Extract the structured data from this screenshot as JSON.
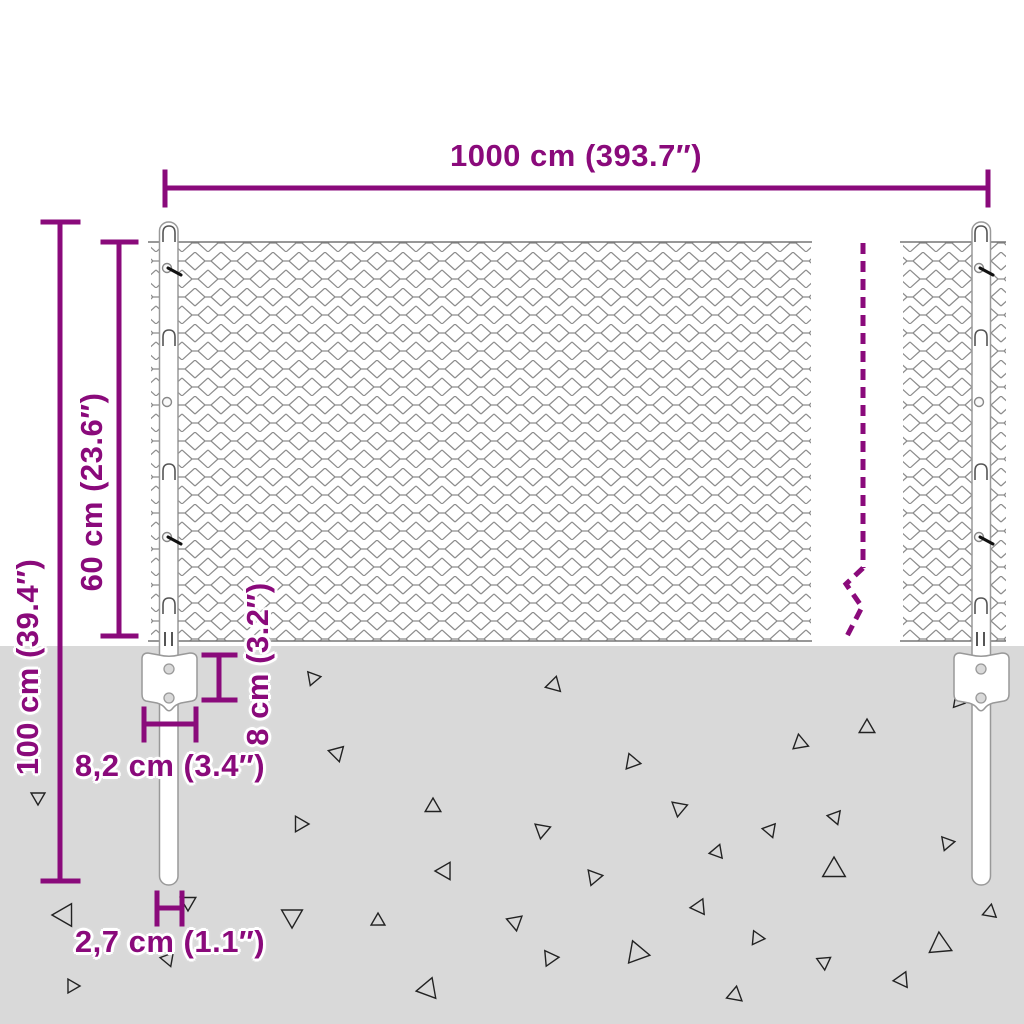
{
  "diagram": {
    "kind": "chain-link fence dimension diagram",
    "dimensions": {
      "total_width": "1000 cm (393.7″)",
      "mesh_height": "60 cm (23.6″)",
      "post_height": "100 cm (39.4″)",
      "anchor_depth": "8 cm (3.2″)",
      "bracket_width": "8,2 cm (3.4″)",
      "post_diameter": "2,7 cm (1.1″)"
    },
    "colors": {
      "accent": "#8A0A7B",
      "ground": "#D9D9D9",
      "mesh": "#8C8C8C",
      "outline": "#999999",
      "background": "#FFFFFF"
    }
  }
}
